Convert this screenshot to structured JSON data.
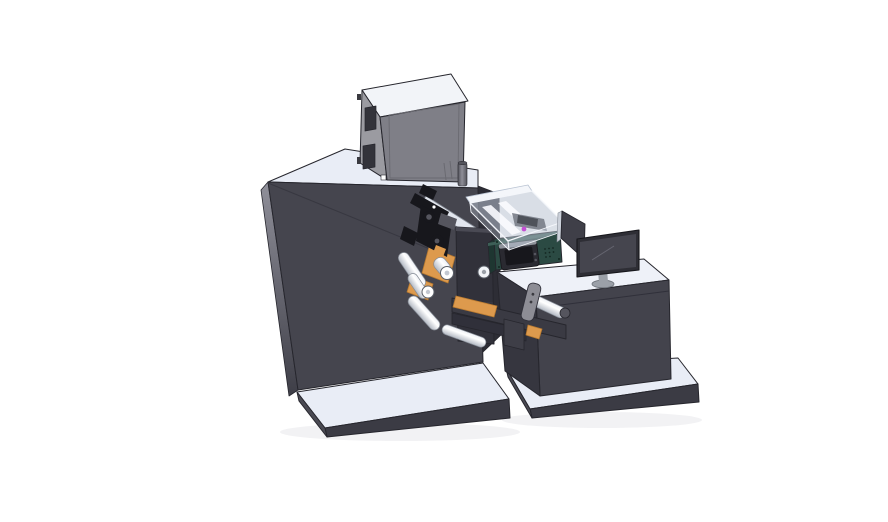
{
  "canvas": {
    "width": 888,
    "height": 522,
    "background": "#ffffff"
  },
  "scene": {
    "description": "Isometric 3D CAD render of a label printing machine line",
    "components": [
      "main machine cabinet",
      "top printer module",
      "exhaust pipe",
      "print mechanism",
      "material rolls",
      "guide rollers",
      "front plate",
      "transfer arm with handle",
      "control box with HMI screen",
      "transparent cover with inner unit",
      "operator desk",
      "monitor",
      "side panel",
      "base platforms"
    ]
  },
  "colors": {
    "edge": "#26262d",
    "body_front": "#45454e",
    "body_seam": "#383841",
    "body_left_top": "#90909a",
    "body_left_bottom": "#3e3e47",
    "surface_light": "#e9edf6",
    "platform_front": "#3b3b44",
    "platform_side": "#4a4a53",
    "recess": "#2d2d35",
    "cube_top": "#f2f4f8",
    "cube_left": "#9b9ba1",
    "cube_front": "#7f7f87",
    "cube_window": "#33333a",
    "cube_panel_line": "#6a6a71",
    "cube_tab": "#3a3a40",
    "pipe_light": "#8e8e98",
    "pipe_dark": "#54545c",
    "guide_bar": "#e2e6ee",
    "mech_black": "#17171c",
    "mech_gray": "#55555e",
    "orange": "#dd9a4d",
    "orange_shadow": "#b87a30",
    "roller_light": "#ffffff",
    "roller_mid": "#eef0f5",
    "roller_dark": "#b4bac4",
    "roller_stroke": "#868c96",
    "plate": "#31313a",
    "plate_bevel": "#4a4a54",
    "beam": "#3a3a43",
    "beam_dark": "#30303a",
    "bracket": "#3e3e47",
    "handle": "#8d8d95",
    "handle_dot": "#3a3a40",
    "teal_front": "#2b4a43",
    "teal_side": "#1e3631",
    "teal_top_edge": "#3d5f57",
    "hmi_frame": "#2a2a31",
    "hmi_screen": "#17171c",
    "hmi_trim": "#8f939b",
    "vent_dot": "#142721",
    "cover_glass": "#b9c3d2",
    "cover_frame": "#f4f6fa",
    "cover_rail": "#fafbfe",
    "cover_inner_gray": "#7d828c",
    "cover_inner_dark": "#4e525a",
    "magenta": "#c44fd4",
    "desk_front": "#43434c",
    "desk_side": "#36363f",
    "desk_top": "#eef1f8",
    "desk_seam": "#30303a",
    "panel_face": "#3f3f48",
    "panel_edge": "#ccd1da",
    "monitor_frame": "#2e2e35",
    "monitor_screen": "#45454e",
    "monitor_glint": "#656570",
    "monitor_stand": "#9ba0a8",
    "monitor_stand_dark": "#6e737b",
    "end_cap": "#c3c8d1",
    "end_ring": "#5a5f68",
    "shadow": "rgba(40,40,60,0.06)",
    "white_detail": "#ffffff"
  }
}
